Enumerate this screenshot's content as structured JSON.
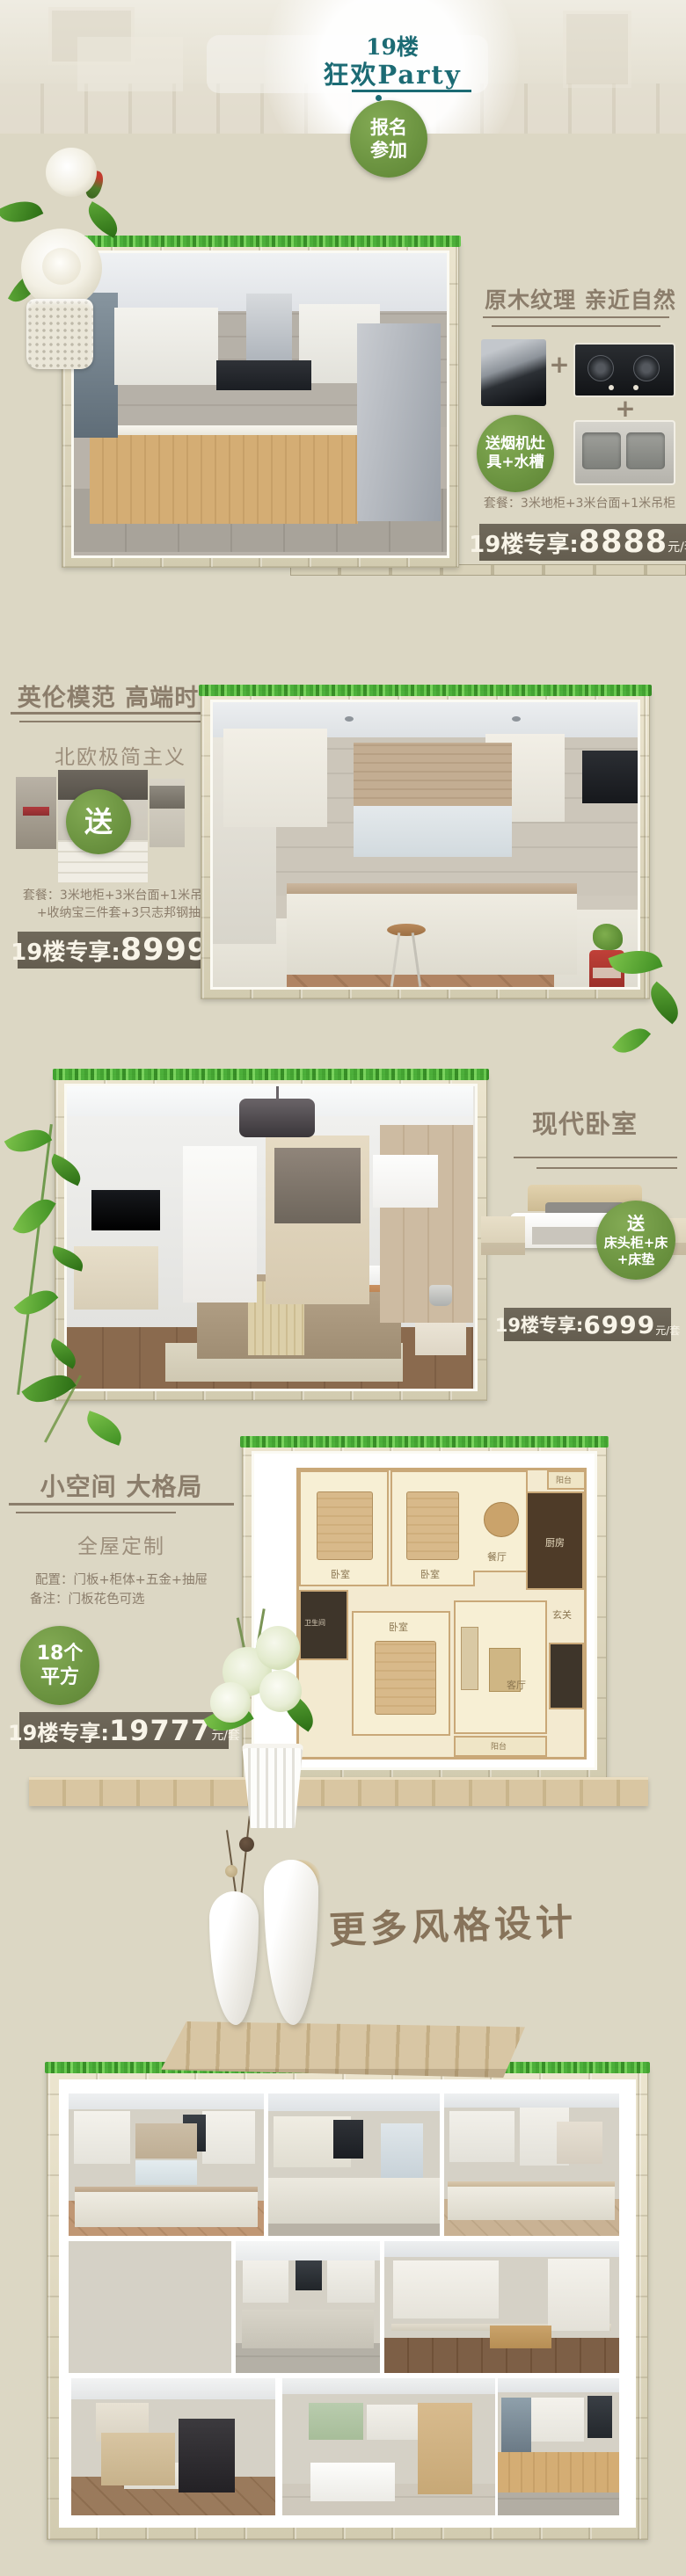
{
  "colors": {
    "teal": "#1c6b74",
    "accent_green": "#6b9340",
    "price_bar_bg": "#6b6454",
    "title_brown": "#8b7d6b",
    "page_bg": "#dcd7c4",
    "frame_grass": "#3ca02b"
  },
  "header": {
    "floor": "19楼",
    "party": "狂欢Party",
    "cta1": "报名",
    "cta2": "参加"
  },
  "s1": {
    "title": "原木纹理 亲近自然",
    "plus": "+",
    "gift1": "送烟机灶",
    "gift2": "具+水槽",
    "package": "套餐：3米地柜+3米台面+1米吊柜",
    "price_label": "19楼专享:",
    "price": "8888",
    "unit": "元/套"
  },
  "s2": {
    "title": "英伦模范 高端时尚",
    "subtitle": "北欧极简主义",
    "gift": "送",
    "pkg1": "套餐：3米地柜+3米台面+1米吊柜",
    "pkg2": "+收纳宝三件套+3只志邦钢抽",
    "price_label": "19楼专享:",
    "price": "8999",
    "unit": "元/套"
  },
  "s3": {
    "title": "现代卧室",
    "gift1": "送",
    "gift2": "床头柜+床",
    "gift3": "+床垫",
    "price_label": "19楼专享:",
    "price": "6999",
    "unit": "元/套"
  },
  "s4": {
    "title": "小空间 大格局",
    "subtitle": "全屋定制",
    "config": "配置：门板+柜体+五金+抽屉",
    "note": "备注：门板花色可选",
    "badge1": "18个",
    "badge2": "平方",
    "price_label": "19楼专享:",
    "price": "19777",
    "unit": "元/套",
    "rooms": [
      {
        "label": "卧室"
      },
      {
        "label": "卧室"
      },
      {
        "label": "餐厅"
      },
      {
        "label": "厨房"
      },
      {
        "label": "阳台"
      },
      {
        "label": "卫生间"
      },
      {
        "label": "卧室"
      },
      {
        "label": "客厅"
      },
      {
        "label": "玄关"
      },
      {
        "label": "阳台"
      }
    ]
  },
  "more": {
    "title": "更多风格设计"
  }
}
